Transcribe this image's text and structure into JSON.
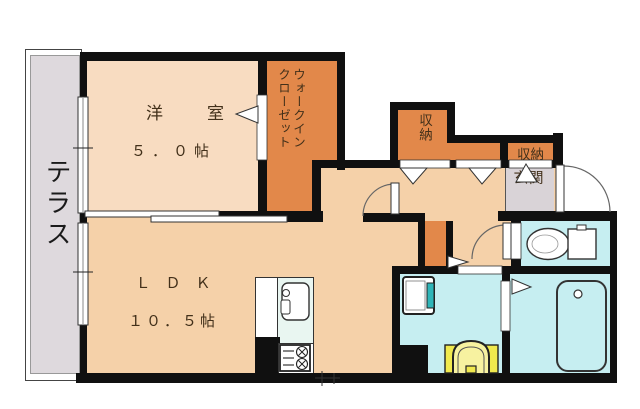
{
  "floor_plan": {
    "rooms": {
      "terrace": {
        "label": "テラス"
      },
      "bedroom": {
        "label": "洋室",
        "area": "５．０帖"
      },
      "ldk": {
        "label": "ＬＤＫ",
        "area": "１０．５帖"
      },
      "walk_in_closet": {
        "label_line1": "ウォークイン",
        "label_line2": "クローゼット"
      },
      "storage_1": {
        "label": "収納"
      },
      "storage_2": {
        "label": "収納"
      },
      "entrance": {
        "label": "玄関"
      }
    },
    "fixtures": {
      "toilet": "toilet-icon",
      "bathtub": "bathtub-icon",
      "washing_machine_pan": "washing-machine-pan-icon",
      "vanity_basin": "vanity-basin-icon",
      "kitchen_sink": "kitchen-sink-icon",
      "gas_stove": "gas-stove-icon",
      "doors": [
        "entrance-door-swing",
        "toilet-door-swing",
        "ldk-door-swing",
        "sliding-door-bedroom-ldk",
        "window-terrace-upper",
        "window-terrace-lower"
      ]
    },
    "colors": {
      "wall": "#101010",
      "room_peach": "#f5d1a9",
      "bedroom_peach": "#f8dcc1",
      "closet_orange": "#e2884a",
      "terrace_gray": "#ded9dd",
      "entrance_gray": "#d9d3d7",
      "wet_cyan": "#c6eef1",
      "vanity_yellow": "#f0e94e",
      "kitchen_counter": "#e9f6f1",
      "line": "#333333",
      "label_ink": "#42301a"
    }
  }
}
